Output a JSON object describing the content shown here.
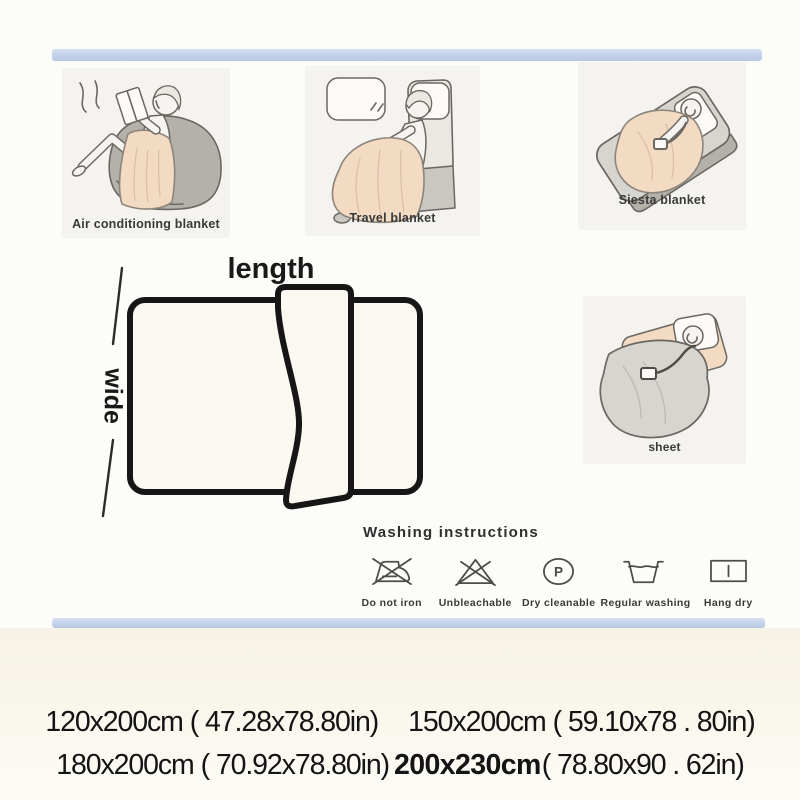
{
  "colors": {
    "strip_blue": "#c3d2ea",
    "strip_blue_deep": "#b7c8e5",
    "panel_bg": "#f4f3ef",
    "blanket_peach": "#f2dac3",
    "line_gray": "#6b6862",
    "gray_dark": "#b4b1ab",
    "gray_mid": "#c9c7c1",
    "gray_light": "#eae8e3",
    "sheet_gray": "#d7d5d0",
    "diagram_fill": "#faf8f0"
  },
  "usage_panels": [
    {
      "label": "Air conditioning blanket",
      "illustration": "person-reading-on-beanbag-with-blanket"
    },
    {
      "label": "Travel blanket",
      "illustration": "person-in-travel-seat-with-blanket"
    },
    {
      "label": "Siesta blanket",
      "illustration": "person-napping-on-bed-with-blanket"
    },
    {
      "label": "sheet",
      "illustration": "blanket-used-as-bed-sheet"
    }
  ],
  "diagram": {
    "length_label": "length",
    "wide_label": "wide"
  },
  "washing": {
    "title": "Washing instructions",
    "items": [
      {
        "label": "Do not iron",
        "icon": "do-not-iron-icon"
      },
      {
        "label": "Unbleachable",
        "icon": "unbleachable-icon"
      },
      {
        "label": "Dry cleanable",
        "icon": "dry-cleanable-icon",
        "symbol": "P"
      },
      {
        "label": "Regular washing",
        "icon": "regular-washing-icon"
      },
      {
        "label": "Hang dry",
        "icon": "hang-dry-icon"
      }
    ]
  },
  "sizes": [
    {
      "cm": "120x200cm",
      "inches": "( 47.28x78.80in)",
      "bold": false
    },
    {
      "cm": "150x200cm",
      "inches": "( 59.10x78 . 80in)",
      "bold": false
    },
    {
      "cm": "180x200cm",
      "inches": "( 70.92x78.80in)",
      "bold": false
    },
    {
      "cm": "200x230cm",
      "inches": "( 78.80x90 . 62in)",
      "bold": true
    }
  ]
}
